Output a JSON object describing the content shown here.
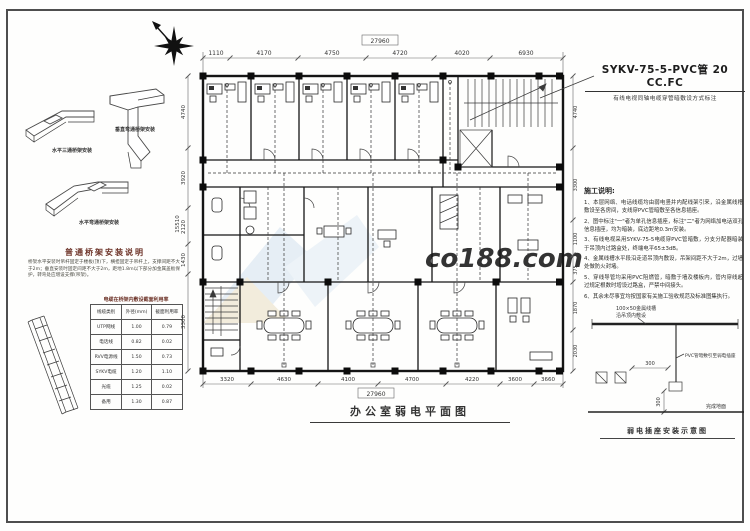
{
  "left_panel": {
    "fitting_captions": [
      "水平三通桥架安装",
      "垂直弯通桥架安装",
      "水平弯通桥架安装"
    ],
    "notes_title": "普通桥架安装说明",
    "notes_body": "桥架水平安装时吊杆固定于楼板(顶)下，横担固定于吊杆上，支撑间距不大于2m；垂直安装时固定间距不大于2m，距地1.8m以下部分加金属盖板保护，转弯处应增设支撑(吊架)。",
    "table_title": "电缆在桥架内敷设截面利用率",
    "table": {
      "headers": [
        "线缆类别",
        "外径(mm)",
        "截面利用率"
      ],
      "rows": [
        [
          "UTP网线",
          "1.00",
          "0.79"
        ],
        [
          "电话线",
          "0.82",
          "0.02"
        ],
        [
          "RVV电源线",
          "1.50",
          "0.73"
        ],
        [
          "SYKV电缆",
          "1.20",
          "1.10"
        ],
        [
          "光缆",
          "1.25",
          "0.02"
        ],
        [
          "备用",
          "1.30",
          "0.87"
        ]
      ]
    }
  },
  "plan": {
    "cable_label": "SYKV-75-5-PVC管 20 CC.FC",
    "cable_sublabel": "有线电视同轴电缆穿管暗敷设方式标注",
    "title": "办公室弱电平面图",
    "dims_top": {
      "overall": "27960",
      "segments": [
        "1110",
        "4170",
        "4750",
        "4720",
        "4020",
        "6930"
      ]
    },
    "dims_bottom": {
      "overall": "27960",
      "segments": [
        "3320",
        "4630",
        "4100",
        "4700",
        "4220",
        "3600",
        "3660"
      ]
    },
    "dims_left": {
      "overall": "15510",
      "segments": [
        "4740",
        "3920",
        "2120",
        "1430",
        "3300"
      ]
    },
    "dims_right": {
      "segments": [
        "4740",
        "3300",
        "1100",
        "375",
        "1870",
        "2030"
      ]
    }
  },
  "notes": {
    "title": "施工说明:",
    "items": [
      "1、本层网络、电话线缆均由弱电竖井内配线架引来，沿金属线槽敷设至各房间，支线穿PVC管暗敷至各信息插座。",
      "2、图中标注\"一\"者为单孔信息插座，标注\"二\"者为网络加电话双孔信息插座，均为暗装，底边距地0.3m安装。",
      "3、有线电视采用SYKV-75-5电缆穿PVC管暗敷，分支分配器暗装于吊顶内过路盒处，终端电平65±3dB。",
      "4、金属线槽水平段沿走道吊顶内敷设，吊架间距不大于2m，过墙处做防火封堵。",
      "5、穿线导管均采用PVC阻燃管，暗敷于墙及楼板内，管内穿线超过规定根数时增设过路盒，严禁中间接头。",
      "6、其余未尽事宜均按国家有关施工验收规范及标准图集执行。"
    ]
  },
  "detail": {
    "tray_label_1": "100×50金属线槽",
    "tray_label_2": "沿吊顶内敷设",
    "conduit_label": "PVC管暗敷引至弱电插座",
    "dim_h": "300",
    "dim_v": "300",
    "floor_label": "完成地面",
    "caption": "弱电插座安装示意图"
  },
  "watermark": {
    "text": "co188.com"
  }
}
